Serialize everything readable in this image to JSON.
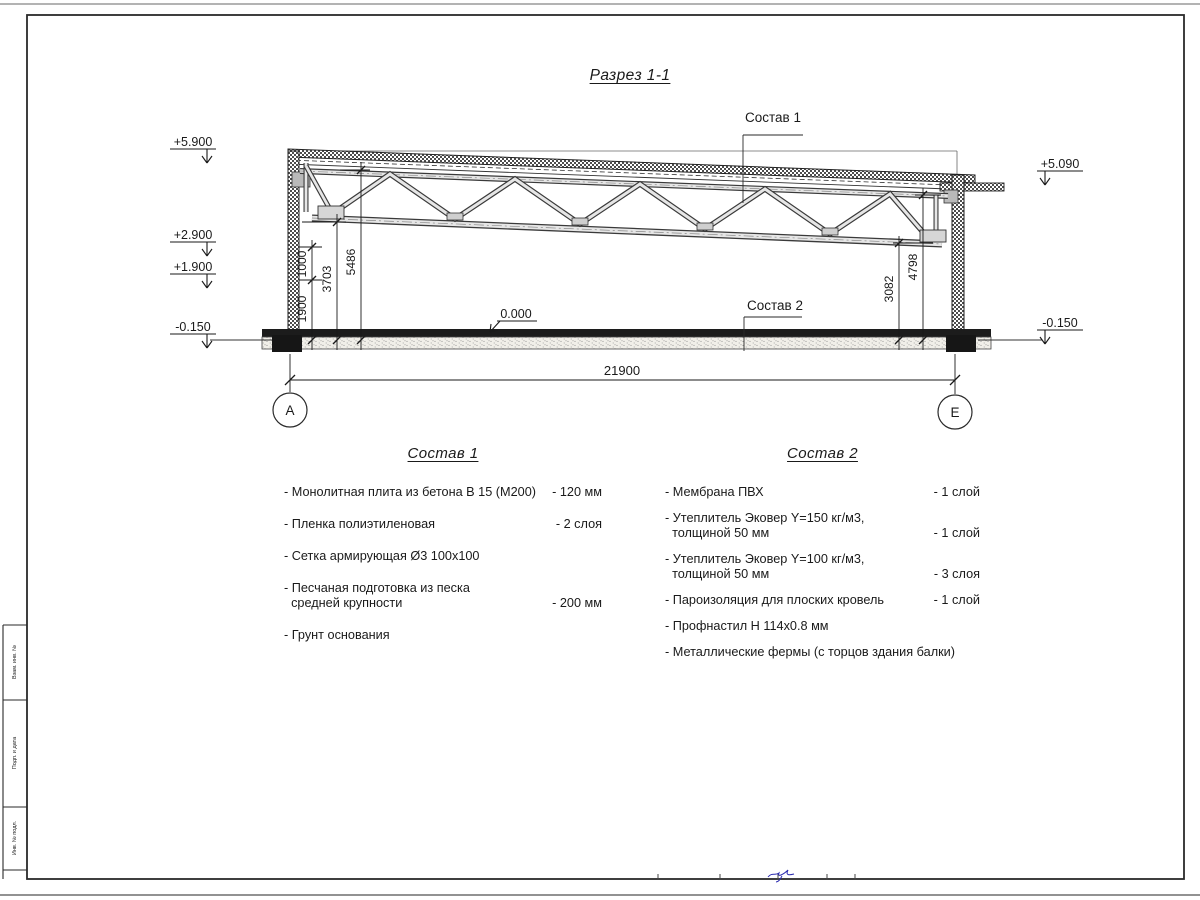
{
  "title": "Разрез 1-1",
  "drawing": {
    "callout_top": "Состав 1",
    "callout_floor": "Состав 2",
    "axis_left": "А",
    "axis_right": "Е",
    "elevations": {
      "roof_left": "+5.900",
      "level_2900": "+2.900",
      "level_1900": "+1.900",
      "base_left": "-0.150",
      "roof_right": "+5.090",
      "base_right": "-0.150",
      "floor": "0.000"
    },
    "dims": {
      "v1000": "1000",
      "v1900": "1900",
      "v3703": "3703",
      "v5486": "5486",
      "v3082": "3082",
      "v4798": "4798",
      "span": "21900"
    }
  },
  "legend1": {
    "heading": "Состав 1",
    "items": [
      {
        "text": "- Монолитная плита из бетона В 15 (М200)",
        "value": "- 120 мм"
      },
      {
        "text": "- Пленка полиэтиленовая",
        "value": "- 2 слоя"
      },
      {
        "text": "- Сетка армирующая Ø3 100х100",
        "value": ""
      },
      {
        "text": "- Песчаная подготовка из песка\n  средней крупности",
        "value": "- 200 мм"
      },
      {
        "text": "- Грунт основания",
        "value": ""
      }
    ]
  },
  "legend2": {
    "heading": "Состав 2",
    "items": [
      {
        "text": "- Мембрана ПВХ",
        "value": "- 1 слой"
      },
      {
        "text": "- Утеплитель Эковер Y=150 кг/м3,\n  толщиной 50 мм",
        "value": "- 1 слой"
      },
      {
        "text": "- Утеплитель Эковер Y=100 кг/м3,\n  толщиной 50 мм",
        "value": "- 3 слоя"
      },
      {
        "text": "- Пароизоляция для плоских кровель",
        "value": "- 1 слой"
      },
      {
        "text": "- Профнастил Н 114х0.8 мм",
        "value": ""
      },
      {
        "text": "- Металлические фермы (с торцов здания балки)",
        "value": ""
      }
    ]
  },
  "frame": {
    "labels": [
      "Взам. инв. №",
      "Подп. и дата",
      "Инв. № подл."
    ]
  }
}
